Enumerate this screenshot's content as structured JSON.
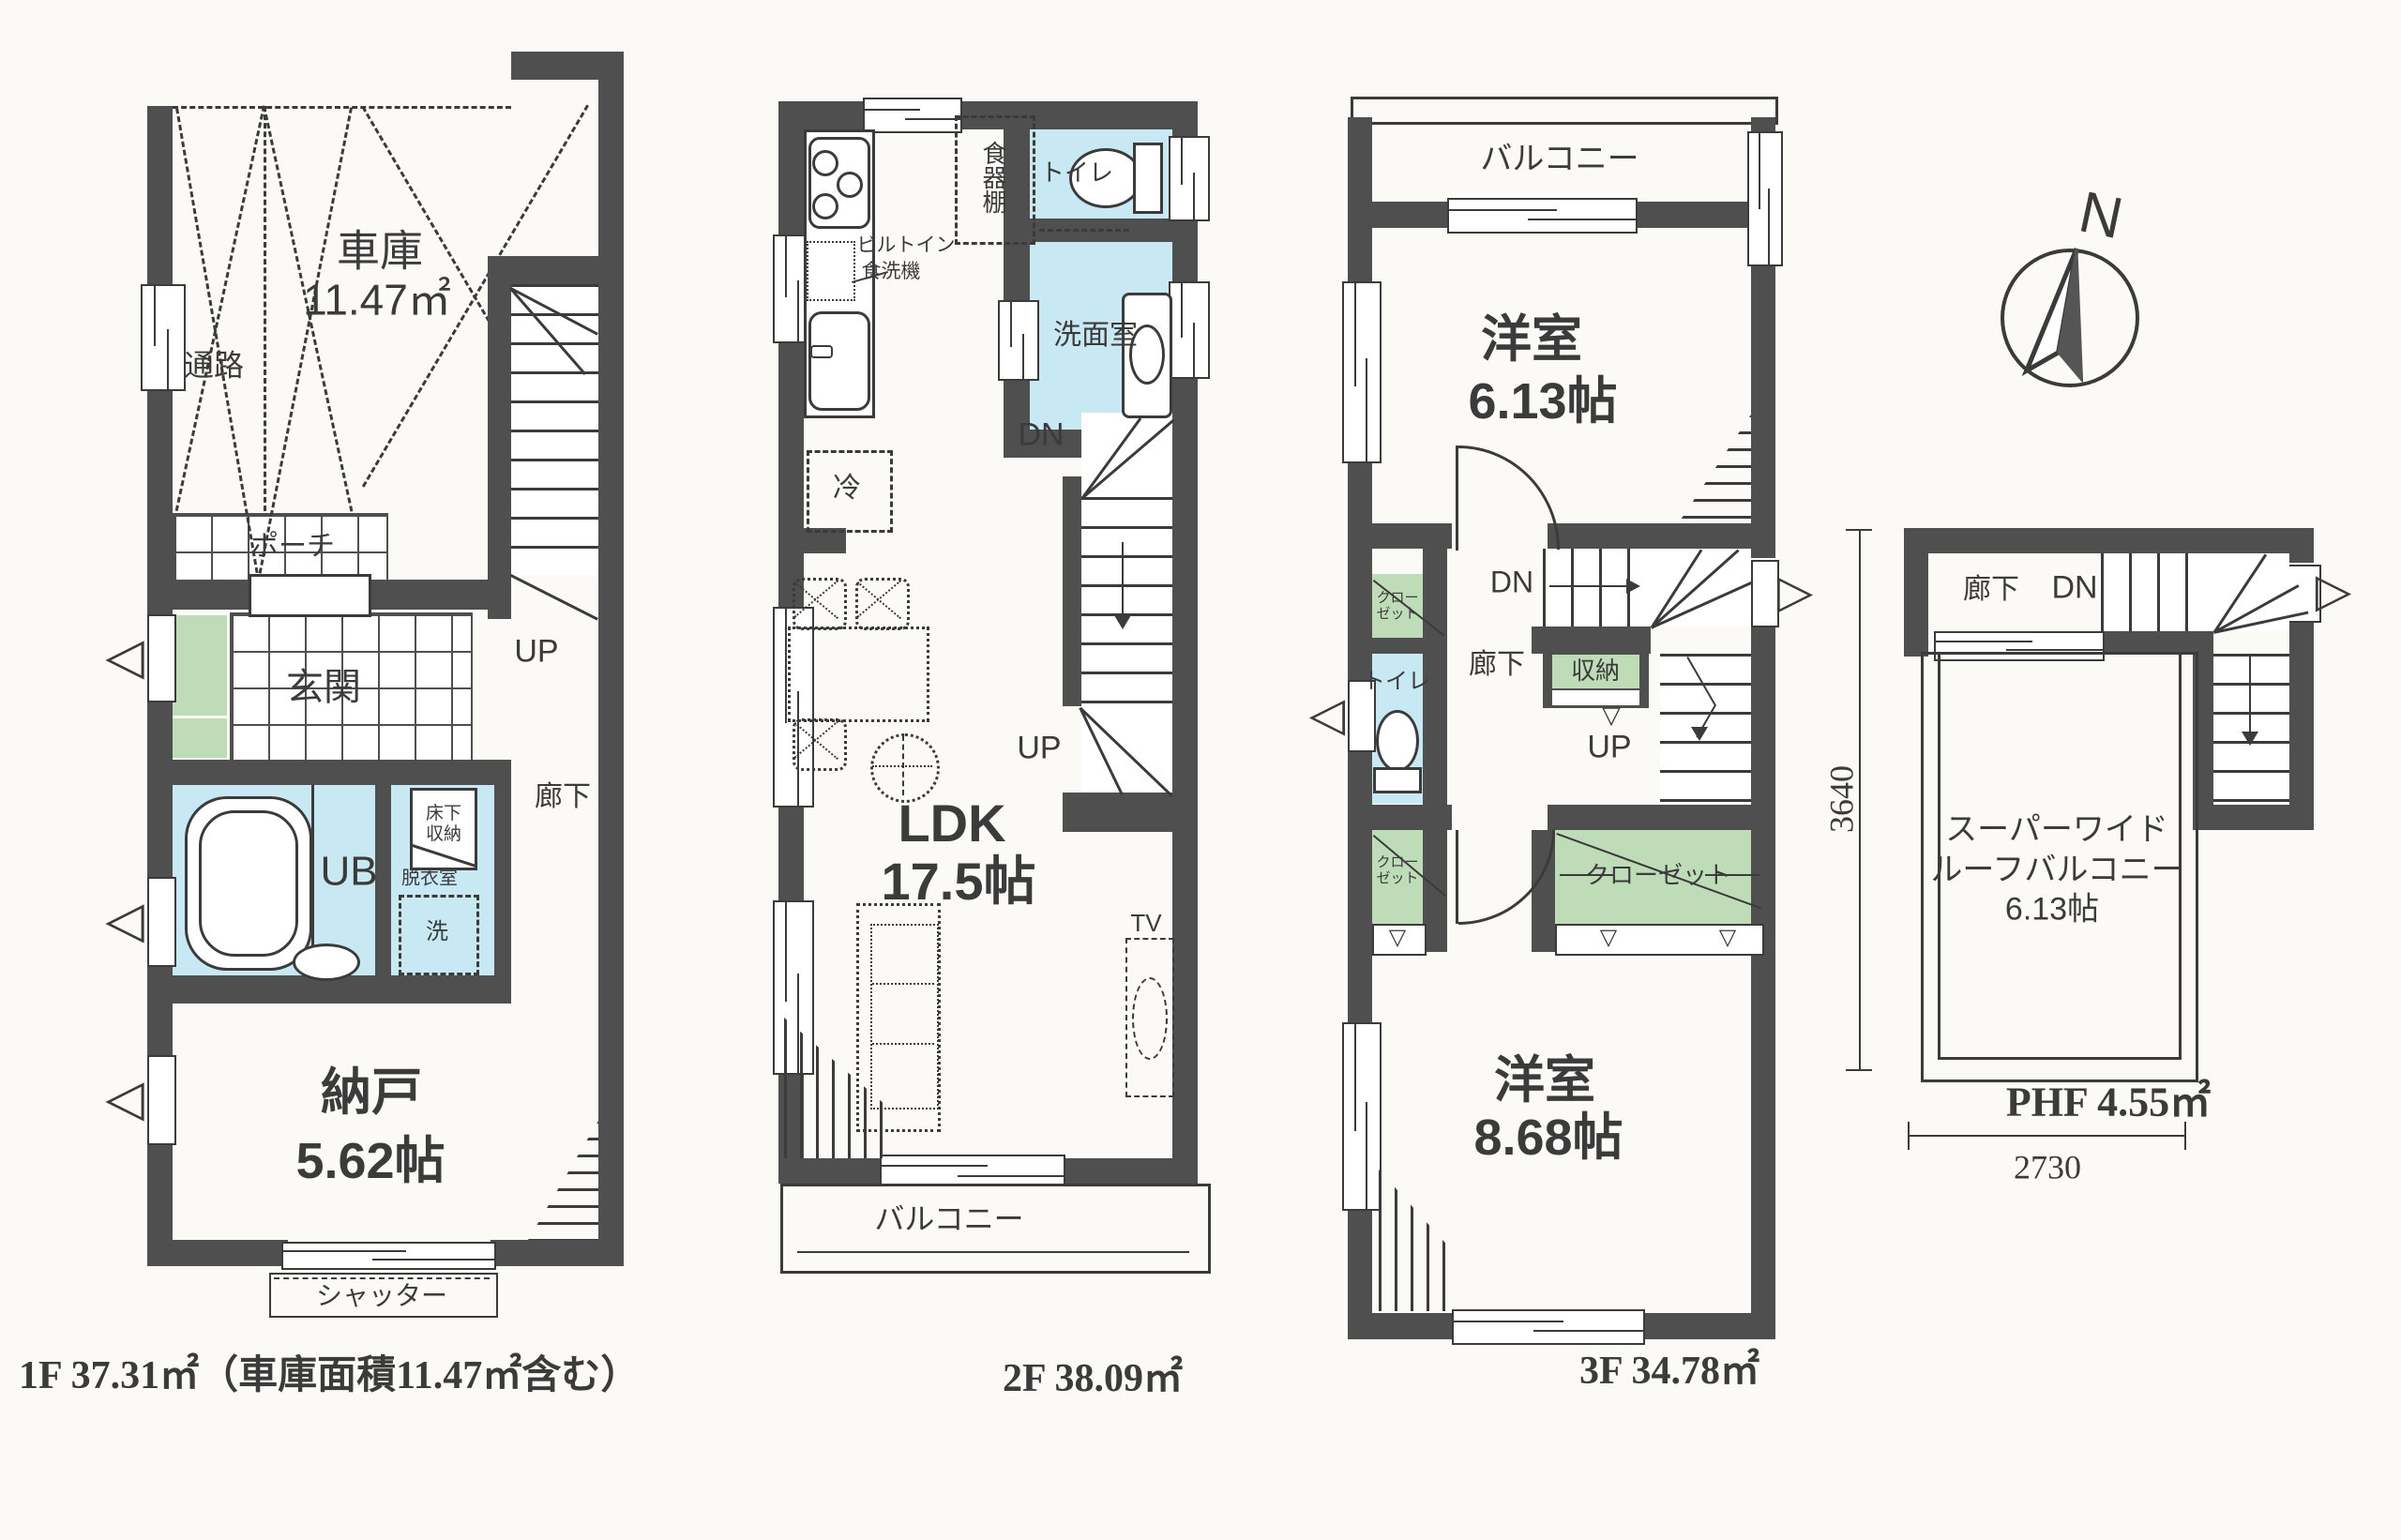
{
  "colors": {
    "wall": "#4f4f4f",
    "water_room": "#c8e8f4",
    "closet_green": "#bedcb8",
    "paper": "#fbfaf6",
    "line": "#3b3b3b"
  },
  "icons": {
    "vent_left": "◁",
    "vent_right": "▷",
    "chevron_down": "▽"
  },
  "floor1": {
    "caption": "1F 37.31㎡（車庫面積11.47㎡含む）",
    "garage_name": "車庫",
    "garage_area": "11.47㎡",
    "passage": "通路",
    "porch": "ポーチ",
    "entrance": "玄関",
    "unit_bath": "UB",
    "underfloor_storage": "床下収納",
    "dressing_room": "脱衣室",
    "washer": "洗",
    "hallway": "廊下",
    "up": "UP",
    "storeroom_name": "納戸",
    "storeroom_area": "5.62帖",
    "shutter": "シャッター"
  },
  "floor2": {
    "caption": "2F 38.09㎡",
    "cupboard": "食器棚",
    "builtin_dw_1": "ビルトイン",
    "builtin_dw_2": "食洗機",
    "toilet": "トイレ",
    "washroom": "洗面室",
    "dn": "DN",
    "up": "UP",
    "fridge": "冷",
    "ldk_name": "LDK",
    "ldk_area": "17.5帖",
    "tv": "TV",
    "balcony": "バルコニー"
  },
  "floor3": {
    "caption": "3F 34.78㎡",
    "balcony": "バルコニー",
    "room1_name": "洋室",
    "room1_area": "6.13帖",
    "closet1": "クローゼット",
    "toilet": "トイレ",
    "hallway": "廊下",
    "dn": "DN",
    "up": "UP",
    "storage": "収納",
    "closet2": "クローゼット",
    "closet3": "クローゼット",
    "room2_name": "洋室",
    "room2_area": "8.68帖"
  },
  "phf": {
    "caption": "PHF 4.55㎡",
    "compass_n": "N",
    "hallway": "廊下",
    "dn": "DN",
    "roof_balcony_line1": "スーパーワイド",
    "roof_balcony_line2": "ルーフバルコニー",
    "roof_balcony_area": "6.13帖",
    "dim_width": "2730",
    "dim_height": "3640"
  }
}
